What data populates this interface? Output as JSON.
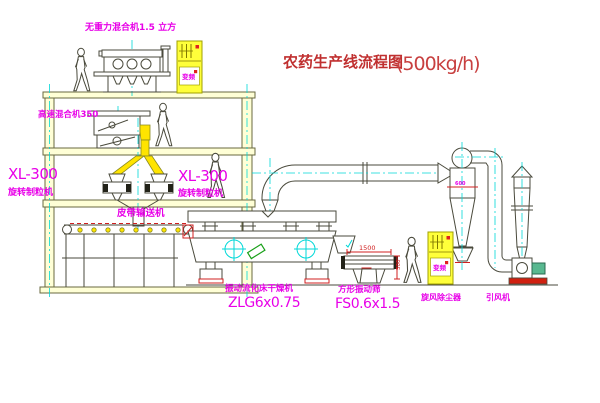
{
  "title": {
    "text": "农药生产线流程图",
    "capacity": "(500kg/h)"
  },
  "labels": {
    "gravity_mixer": "无重力混合机1.5 立方",
    "high_speed_mixer": "高速混合机350",
    "granulator_left_model": "XL-300",
    "granulator_left_name": "旋转制粒机",
    "granulator_right_model": "XL-300",
    "granulator_right_name": "旋转制粒机",
    "belt_conveyor": "皮带输送机",
    "dryer_name": "振动流化床干燥机",
    "dryer_model": "ZLG6x0.75",
    "screen_name": "方形振动筛",
    "screen_model": "FS0.6x1.5",
    "cyclone_name": "旋风除尘器",
    "fan_name": "引风机"
  },
  "dimensions": {
    "screen_length": "1500",
    "screen_height": "500",
    "cyclone_dia": "600"
  },
  "cabinets": {
    "cabinet1_text": "变频",
    "cabinet2_text": "变频"
  },
  "colors": {
    "line": "#4a4a3c",
    "building": "#6a6a40",
    "yellow": "#ffe400",
    "cyan": "#00d8d8",
    "magenta": "#e800e8",
    "red": "#d02020",
    "title_red": "#c03030",
    "green": "#18a018"
  }
}
